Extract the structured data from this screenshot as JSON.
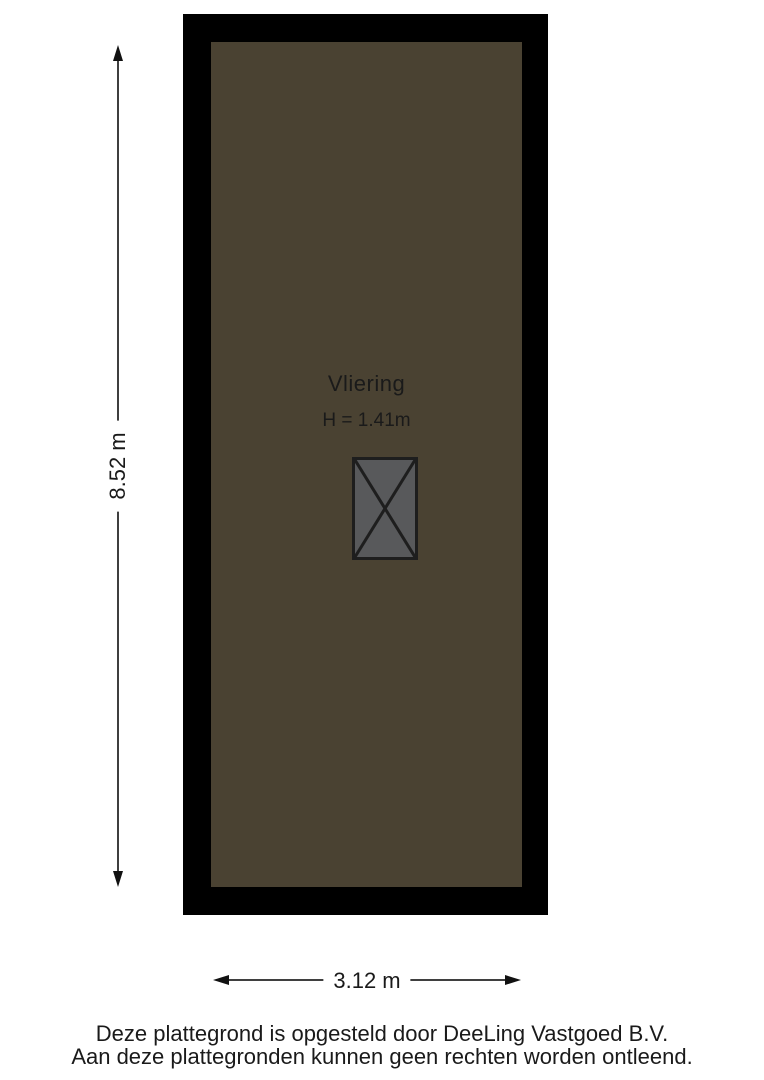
{
  "plan": {
    "room_name": "Vliering",
    "room_height": "H = 1.41m"
  },
  "dimensions": {
    "vertical": "8.52 m",
    "horizontal": "3.12 m"
  },
  "footer": {
    "line1": "Deze plattegrond is opgesteld door DeeLing Vastgoed B.V.",
    "line2": "Aan deze plattegronden kunnen geen rechten worden ontleend."
  },
  "colors": {
    "wall": "#000000",
    "floor": "#4a4232",
    "stair_fill": "#58595b",
    "stair_border": "#1e1e1e",
    "line": "#3f3f3f",
    "arrow": "#111111",
    "text": "#1a1a1a",
    "page_bg": "#ffffff"
  }
}
